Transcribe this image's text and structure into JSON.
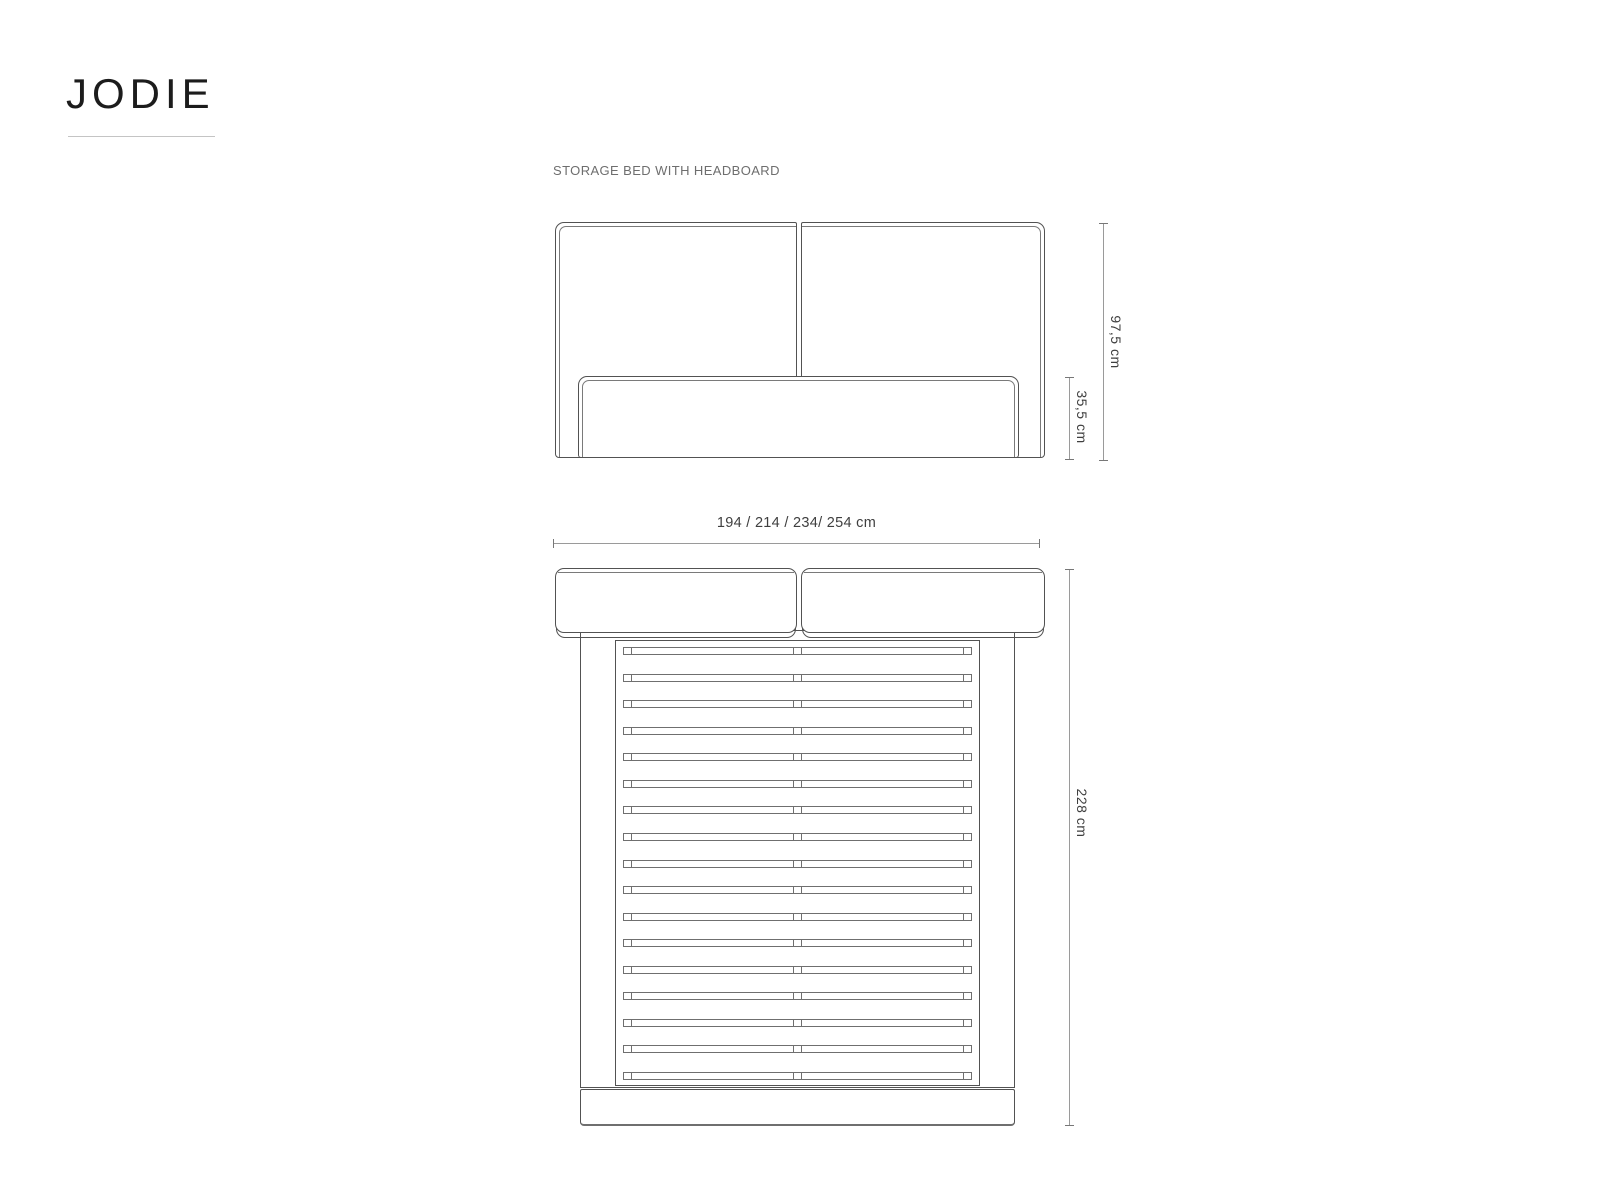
{
  "brand": "JODIE",
  "subtitle": "STORAGE BED WITH HEADBOARD",
  "front_view": {
    "dimensions": {
      "total_height": "97,5 cm",
      "base_height": "35,5 cm"
    }
  },
  "top_view": {
    "dimensions": {
      "width": "194 / 214 / 234/ 254 cm",
      "length": "228 cm"
    },
    "slat_count": 17
  },
  "colors": {
    "background": "#ffffff",
    "line_main": "#525252",
    "line_seam": "#7a7a7a",
    "line_soft": "#6f6f6f",
    "line_dim": "#9a9a9a",
    "text_brand": "#1c1c1c",
    "text_subtitle": "#6e6e6e",
    "text_dim": "#3f3f3f",
    "underline": "#c4c4c4"
  }
}
